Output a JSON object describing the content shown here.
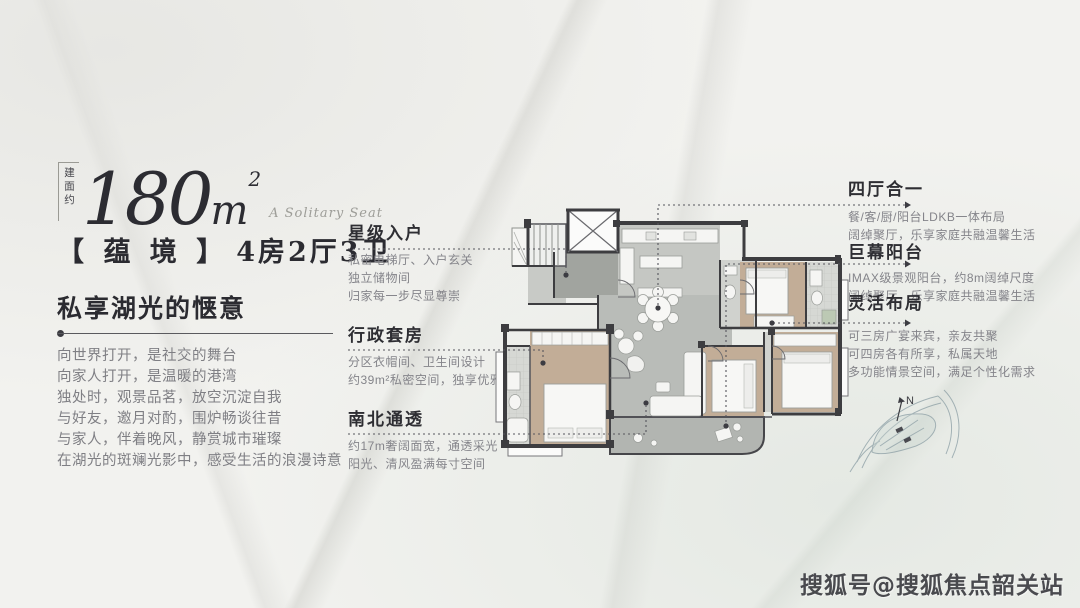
{
  "badge": {
    "vertical_label": "建面约",
    "area_value": "180",
    "area_unit": "m",
    "area_sup": "2",
    "script_caption": "A Solitary Seat"
  },
  "unit": {
    "name_bracketed": "【 蕴 境 】",
    "spec": "4房2厅3卫"
  },
  "intro": {
    "heading": "私享湖光的惬意",
    "lines": [
      "向世界打开，是社交的舞台",
      "向家人打开，是温暖的港湾",
      "独处时，观景品茗，放空沉淀自我",
      "与好友，邀月对酌，围炉畅谈往昔",
      "与家人，伴着晚风，静赏城市璀璨",
      "在湖光的斑斓光影中，感受生活的浪漫诗意"
    ]
  },
  "callouts_left": [
    {
      "title": "星级入户",
      "lines": [
        "私密电梯厅、入户玄关",
        "独立储物间",
        "归家每一步尽显尊崇"
      ]
    },
    {
      "title": "行政套房",
      "lines": [
        "分区衣帽间、卫生间设计",
        "约39m²私密空间，独享优雅起居"
      ]
    },
    {
      "title": "南北通透",
      "lines": [
        "约17m奢阔面宽，通透采光",
        "阳光、清风盈满每寸空间"
      ]
    }
  ],
  "callouts_right": [
    {
      "title": "四厅合一",
      "lines": [
        "餐/客/厨/阳台LDKB一体布局",
        "阔绰聚厅，乐享家庭共融温馨生活"
      ]
    },
    {
      "title": "巨幕阳台",
      "lines": [
        "IMAX级景观阳台，约8m阔绰尺度",
        "阔绰聚厅，乐享家庭共融温馨生活"
      ]
    },
    {
      "title": "灵活布局",
      "lines": [
        "可三房广宴来宾，亲友共聚",
        "可四房各有所享，私属天地",
        "多功能情景空间，满足个性化需求"
      ]
    }
  ],
  "floorplan": {
    "compass_label": "N"
  },
  "watermark": "搜狐号@搜狐焦点韶关站",
  "colors": {
    "text_dark": "#2d2d33",
    "text_gray": "#85858a",
    "leader": "#55555c",
    "wall": "#3d3d40",
    "floor_gray": "#b9bcb8",
    "floor_gray_dark": "#a1a49f",
    "floor_gray_light": "#c5c7c3",
    "floor_tan": "#c2ad97",
    "furniture": "#f5f5f3",
    "balcony": "#b2b5b1",
    "sketch": "#7e939b",
    "watermark": "#35353b"
  }
}
